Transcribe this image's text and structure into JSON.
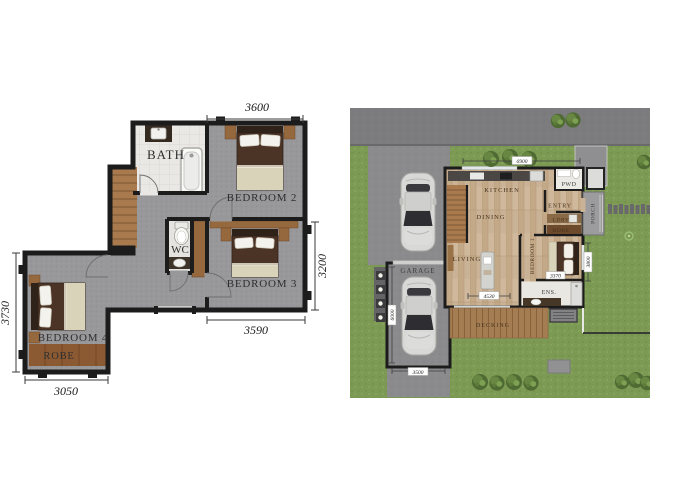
{
  "first_floor": {
    "rooms": {
      "bath": "BATH",
      "bedroom2": "BEDROOM 2",
      "wc": "WC",
      "bedroom3": "BEDROOM 3",
      "bedroom4": "BEDROOM 4",
      "robe": "ROBE"
    },
    "dimensions": {
      "top": "3600",
      "right": "3200",
      "bottom_right": "3590",
      "left": "3730",
      "bottom_left": "3050"
    }
  },
  "ground_floor": {
    "rooms": {
      "kitchen": "KITCHEN",
      "dining": "DINING",
      "living": "LIVING",
      "entry": "ENTRY",
      "laundry": "LDRY",
      "robe": "ROBE",
      "powder": "PWD",
      "bedroom1": "BEDROOM 1",
      "ensuite": "ENS.",
      "porch": "PORCH",
      "garage": "GARAGE",
      "decking": "DECKING"
    },
    "dimensions": {
      "top": "6900",
      "living": "4530",
      "bedroom1": "3370",
      "garage_depth": "6000",
      "garage_width": "3500",
      "side": "3800"
    }
  },
  "colors": {
    "wall": "#1c1c1c",
    "carpet": "#98989a",
    "bath_tile": "#e9e8e4",
    "timber_floor": "#c9b295",
    "stair_wood": "#a87a4e",
    "robe_wood": "#8b5a33",
    "bed_brown": "#4b3425",
    "bed_cream": "#d9d3ba",
    "grass": "#7c9a53",
    "road": "#7c7c7e",
    "driveway": "#8b8b8d",
    "deck": "#a57d52",
    "car_body": "#d8d8d6"
  }
}
